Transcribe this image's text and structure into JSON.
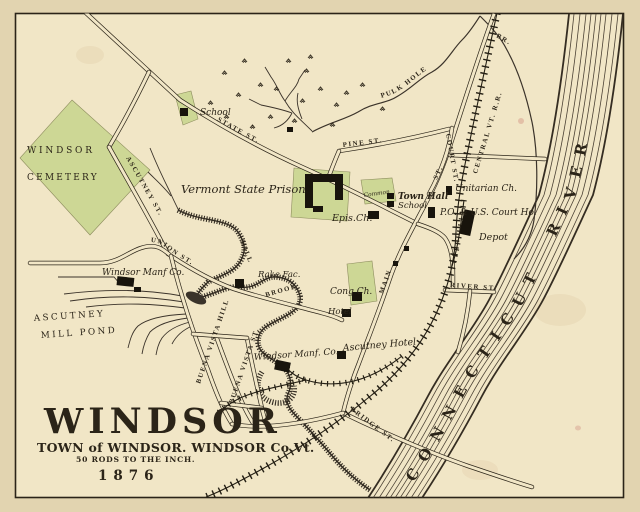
{
  "title_block": {
    "title": "WINDSOR",
    "subtitle": "TOWN of WINDSOR. WINDSOR Co.Vt.",
    "scale_note": "50 RODS TO THE INCH.",
    "year": "1876"
  },
  "water": {
    "river": "CONNECTICUT RIVER",
    "pulk_hole": "PULK HOLE",
    "br": "BR.",
    "mill": "MILL",
    "brook": "BROOK",
    "pond_line1": "ASCUTNEY",
    "pond_line2": "MILL POND"
  },
  "railroad": {
    "central_vt": "CENTRAL VT. R.R."
  },
  "streets": {
    "state": "STATE ST.",
    "pine": "PINE ST.",
    "court": "COURT ST.",
    "main": "MAIN",
    "main_st": "ST.",
    "ascutney": "ASCUTNEY ST.",
    "union": "UNION ST.",
    "buena_vista_hill": "BUENA VISTA HILL",
    "buena_vista_st": "BUENA VISTA ST.",
    "river_st": "RIVER ST.",
    "bridge": "BRIDGE ST."
  },
  "places": {
    "cemetery_line1": "WINDSOR",
    "cemetery_line2": "CEMETERY",
    "school_nw": "School",
    "prison": "Vermont State Prison",
    "episcopal_church": "Epis.Ch.",
    "common": "Common",
    "town_hall": "Town Hall",
    "school": "School",
    "unitarian_church": "Unitarian Ch.",
    "post_office_courthouse": "P.O. & U.S. Court Ho.",
    "depot": "Depot",
    "congregational_church": "Cong Ch.",
    "hotel": "Hotel",
    "windsor_manf_north": "Windsor Manf Co.",
    "rake_factory": "Rake Fac.",
    "windsor_manf_south": "Windsor Manf. Co.",
    "ascutney_hotel": "Ascutney Hotel"
  },
  "colors": {
    "paper": "#e2d4b0",
    "map_bg": "#f1e6c6",
    "lot_green": "#cdd795",
    "ink": "#2b2418"
  }
}
